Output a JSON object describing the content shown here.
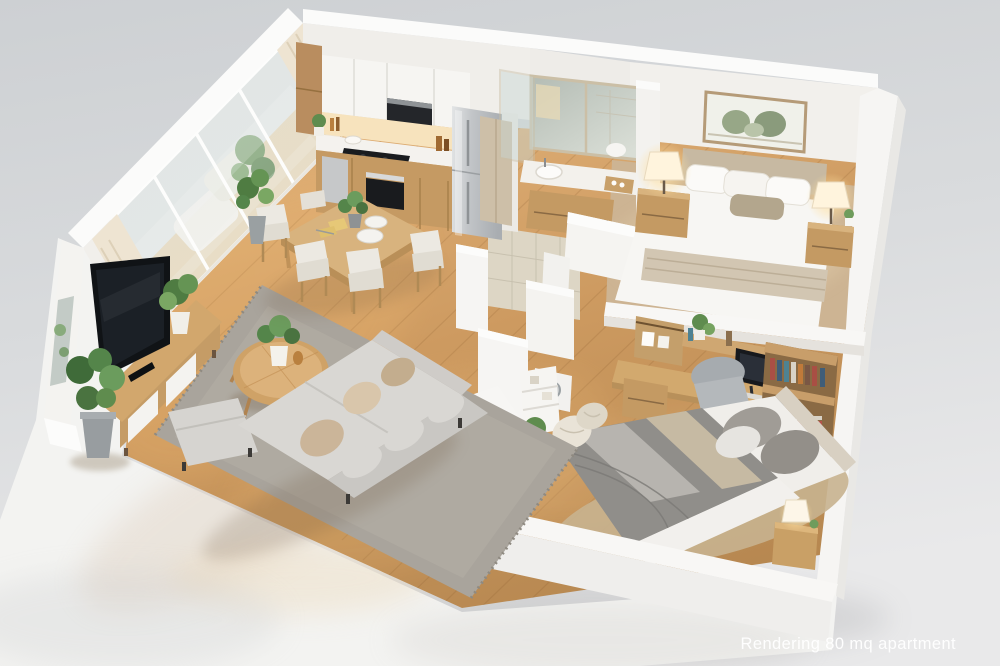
{
  "caption": {
    "text": "Rendering 80 mq apartment"
  },
  "scene": {
    "description": "Isometric 3D cutaway rendering of an 80 square meter apartment with white cut walls on a white base",
    "area_label": "80 mq",
    "rooms": [
      {
        "name": "Living room",
        "items": [
          "flat TV",
          "wood media console with white drawers",
          "grey sectional sofa",
          "chaise ottoman",
          "round wood coffee table",
          "grey fringed rug",
          "tall potted plant"
        ]
      },
      {
        "name": "Kitchen",
        "items": [
          "white upper cabinets",
          "black microwave",
          "black cooktop",
          "built-in oven",
          "stainless refrigerator",
          "wood lower cabinets",
          "white countertop"
        ]
      },
      {
        "name": "Dining area",
        "items": [
          "rectangular wood table",
          "cream shell chairs",
          "white plates",
          "yellow napkins",
          "green centerpiece plant"
        ]
      },
      {
        "name": "Bathroom",
        "items": [
          "double framed mirror",
          "vanity with white sink",
          "wood vanity cabinet",
          "glass shower screen",
          "beige tile floor"
        ]
      },
      {
        "name": "Master bedroom",
        "items": [
          "double bed with beige throw",
          "upholstered headboard",
          "framed botanical print",
          "two wood nightstands",
          "two lit table lamps",
          "beige carpet"
        ]
      },
      {
        "name": "Study nook",
        "items": [
          "wood desk",
          "computer monitor",
          "grey desk chair",
          "bookshelf with books",
          "hanging wall cabinet"
        ]
      },
      {
        "name": "Second bedroom",
        "items": [
          "double bed with grey striped blanket",
          "wood nightstand",
          "small white lamp",
          "white wall shelf",
          "potted plant",
          "beige rug"
        ]
      },
      {
        "name": "Balcony",
        "items": [
          "white sliding glass doors",
          "cream curtains",
          "white outdoor lounge",
          "green plants"
        ]
      }
    ]
  },
  "palette": {
    "background_top": "#cdd0d3",
    "background_bottom": "#e9e9ea",
    "wall_white": "#f5f4f1",
    "wood_floor": "#c9975d",
    "furniture_wood": "#c59e68",
    "sofa_grey": "#d6d4d0",
    "rug_grey": "#aaa59d",
    "carpet_beige": "#cdb493",
    "tile_beige": "#ddd6c5",
    "appliance_steel": "#c9cbcd",
    "screen_black": "#17191d",
    "lamp_glow": "#ffe9bf",
    "plant_green": "#5f8c4e",
    "caption_color": "#ffffff"
  }
}
